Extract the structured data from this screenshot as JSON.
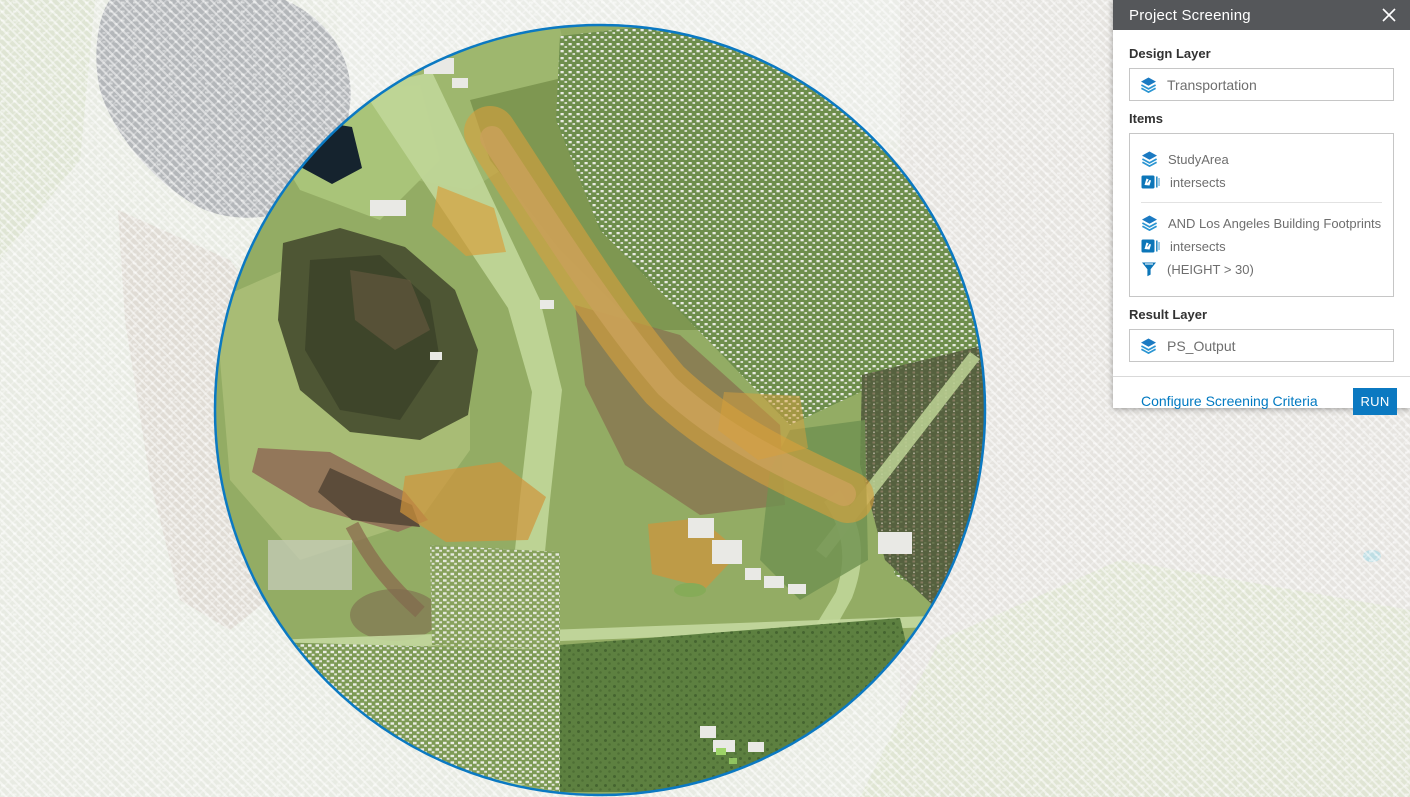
{
  "panel": {
    "title": "Project Screening",
    "design_layer": {
      "label": "Design Layer",
      "value": "Transportation"
    },
    "items": {
      "label": "Items",
      "groups": [
        {
          "layer": "StudyArea",
          "relation": "intersects"
        },
        {
          "layer": "AND Los Angeles Building Footprints",
          "relation": "intersects",
          "filter": "(HEIGHT > 30)"
        }
      ]
    },
    "result_layer": {
      "label": "Result Layer",
      "value": "PS_Output"
    },
    "footer": {
      "configure_link": "Configure Screening Criteria",
      "run_button": "RUN"
    }
  },
  "map": {
    "colors": {
      "accent_blue": "#0079c1",
      "panel_header_gray": "#55575a",
      "study_circle_stroke": "#0b79c2",
      "screening_highlight_orange": "#d79f3c",
      "masked_basemap_tint": "#e8ebe3"
    },
    "icons": [
      "layers-icon",
      "intersect-icon",
      "funnel-icon",
      "close-icon"
    ]
  }
}
